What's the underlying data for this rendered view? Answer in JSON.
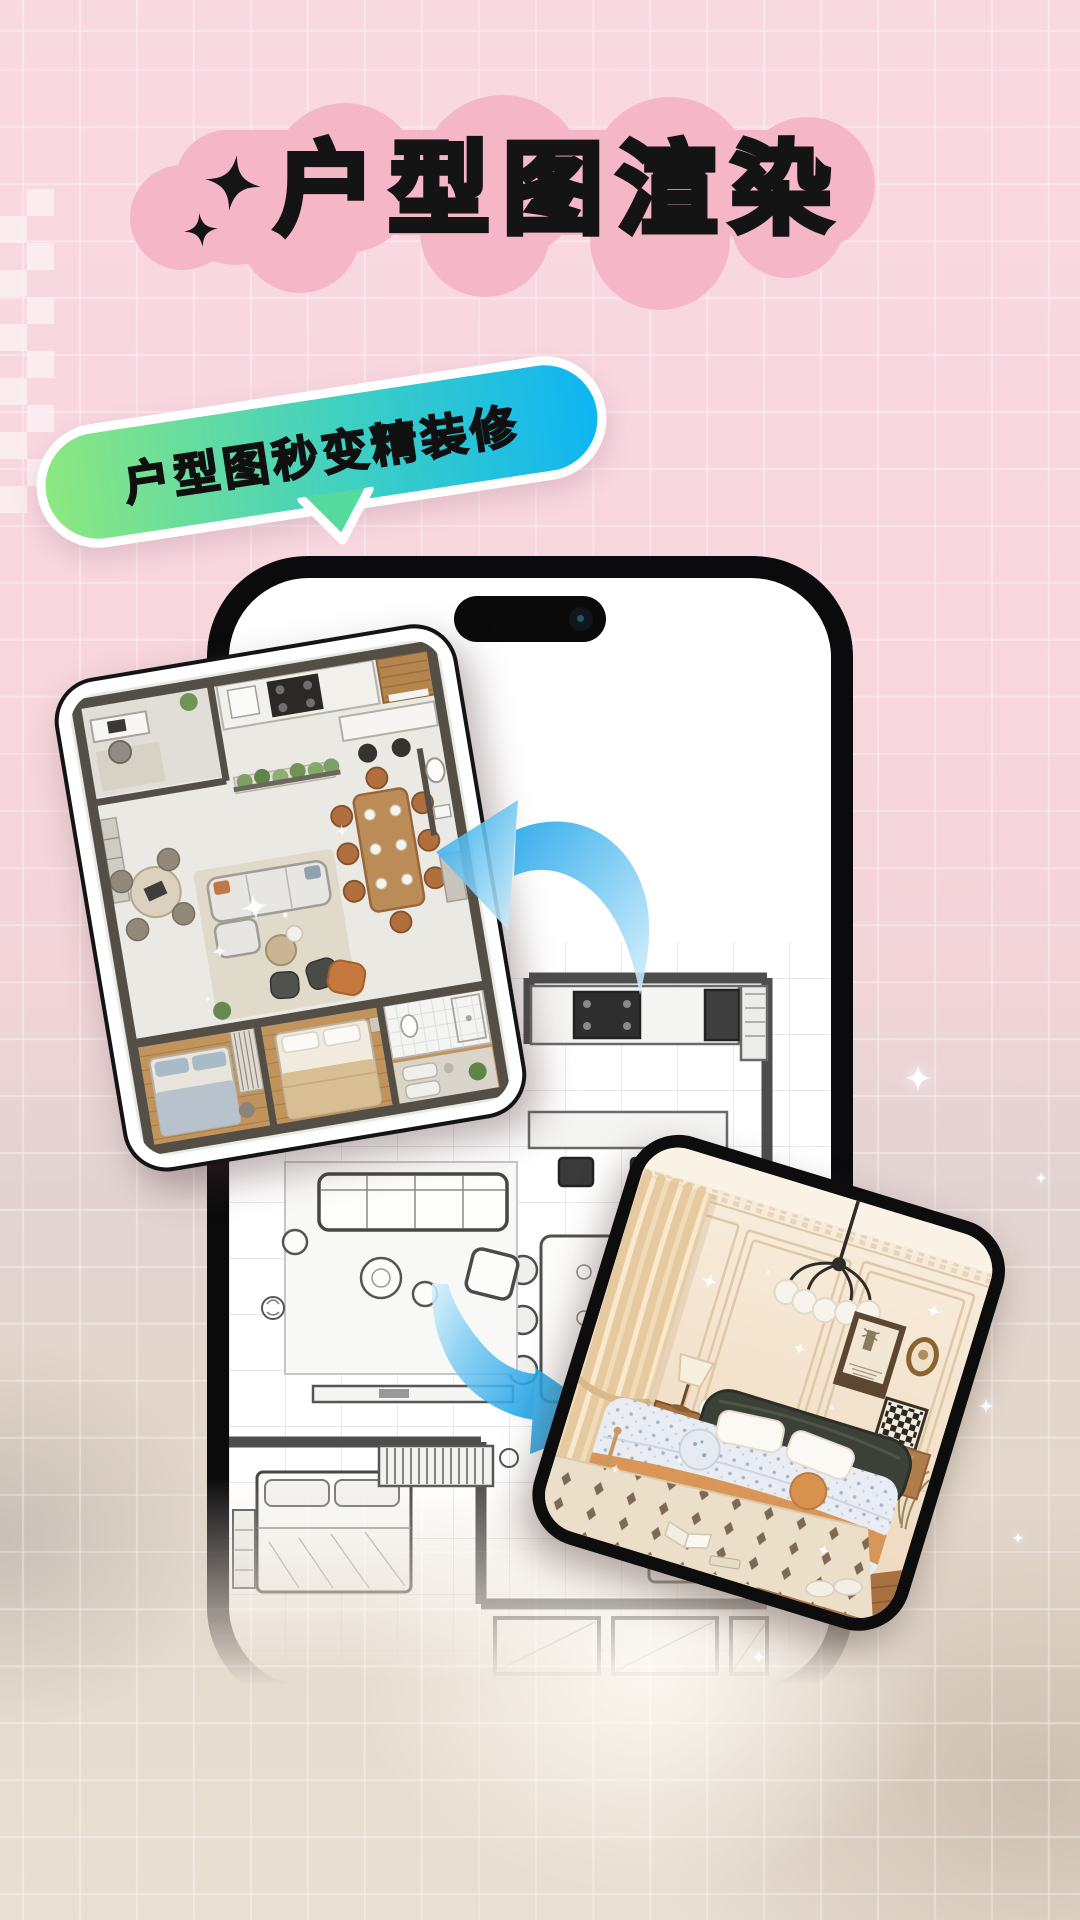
{
  "poster": {
    "title": "户型图渲染",
    "bubble_text": "户型图秒变精装修"
  },
  "colors": {
    "background_pink": "#F8D7DE",
    "title_blob_pink": "#F5B6C8",
    "title_text": "#141414",
    "bubble_gradient_start": "#8DE87F",
    "bubble_gradient_mid": "#3ED0C2",
    "bubble_gradient_end": "#0FB5F3",
    "bubble_border": "#FFFFFF",
    "arrow_blue": "#2AA9EA",
    "phone_frame_black": "#0B0B0D",
    "bottom_beige": "#E7DDD1"
  },
  "icons": {
    "black_sparkle_icon": "four-point-star",
    "white_sparkle_icon": "four-point-star-glow",
    "arrow_left_icon": "curved-arrow-pointing-left",
    "arrow_right_icon": "curved-arrow-pointing-right",
    "dynamic_island": "phone-notch-pill",
    "camera_icon": "front-camera-dot"
  },
  "images": {
    "rendered_floorplan_photo": "3D rendered top-view interior floor plan",
    "sketch_floorplan": "hand-drawn black and white floor plan sketch on phone screen",
    "bedroom_photo": "rendered beige bedroom with chandelier, framed art and double bed"
  }
}
